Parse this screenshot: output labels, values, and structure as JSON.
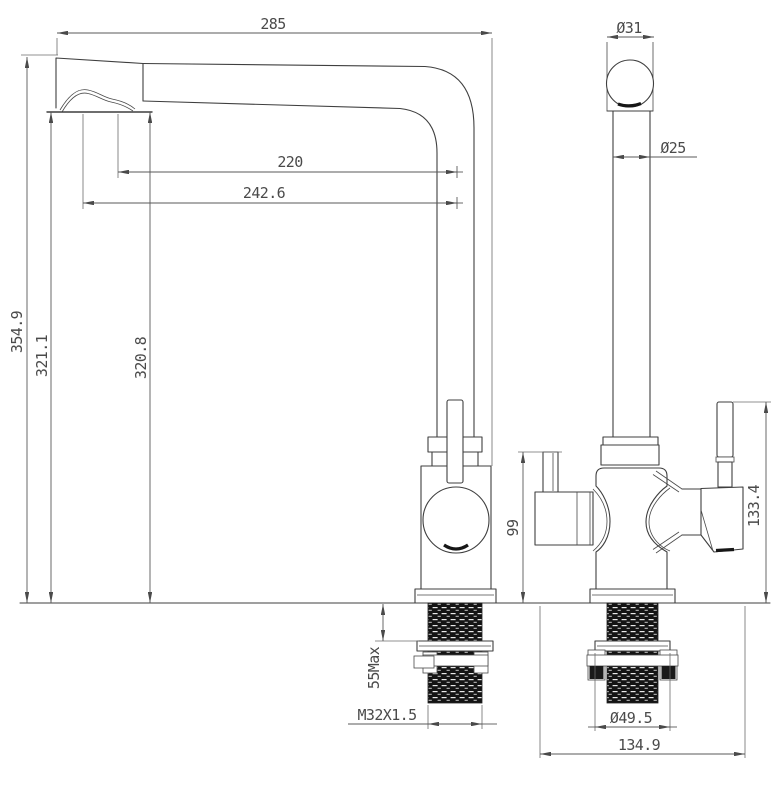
{
  "meta": {
    "type": "technical-drawing",
    "subject": "Two-view dimensional CAD drawing of a kitchen filter faucet (front elevation and side elevation) with mounting shank detail"
  },
  "colors": {
    "background": "#ffffff",
    "geometry_line": "#3f3f3f",
    "dimension_line": "#585858",
    "dimension_text": "#4a4a4a",
    "thread_fill": "#141414"
  },
  "views": {
    "front": {
      "label": "front view"
    },
    "side": {
      "label": "side view"
    }
  },
  "dimensions": {
    "spout_reach_overall": "285",
    "head_diameter": "Ø31",
    "tube_diameter": "Ø25",
    "spout_reach_inner": "220",
    "spout_reach_outer": "242.6",
    "overall_height": "354.9",
    "spout_height_outer": "321.1",
    "spout_height_inner": "320.8",
    "filter_lever_height": "99",
    "handle_height": "133.4",
    "max_counter_thickness": "55Max",
    "shank_thread": "M32X1.5",
    "washer_diameter": "Ø49.5",
    "body_depth": "134.9"
  }
}
